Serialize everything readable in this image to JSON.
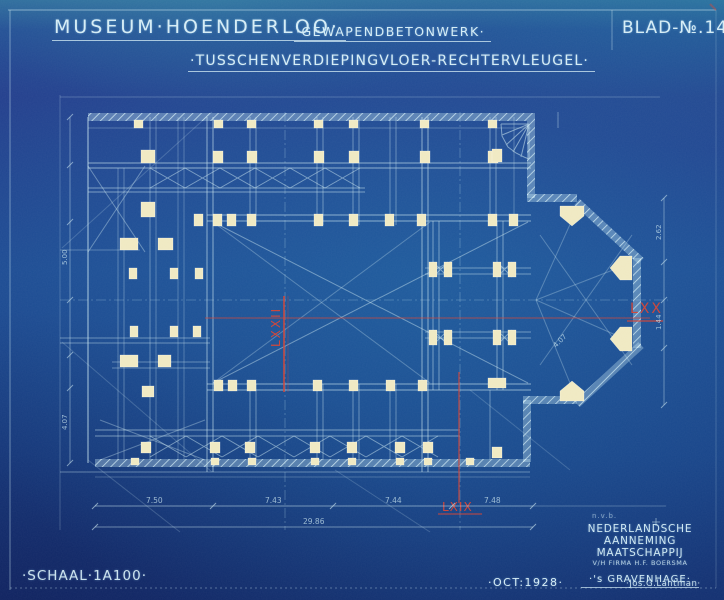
{
  "header": {
    "title": "MUSEUM·HOENDERLOO·",
    "work_type": "·GEWAPENDBETONWERK·",
    "sheet_no": "BLAD-№.14.",
    "drawing_title": "·TUSSCHENVERDIEPINGVLOER-RECHTERVLEUGEL·"
  },
  "footer": {
    "scale": "·SCHAAL·1A100·",
    "date": "·OCT:1928·",
    "signature": "·Jos.G.Lantman·",
    "stamp": "n.v.b.",
    "company": {
      "line1": "NEDERLANDSCHE",
      "line2": "AANNEMING MAATSCHAPPIJ",
      "line3": "V/H FIRMA H.F. BOERSMA",
      "line4": "·'s GRAVENHAGE·"
    }
  },
  "plan": {
    "section_marks": {
      "center_vertical": "LXXII",
      "lower_vertical": "LXIX",
      "horizontal": "LXX"
    },
    "dimensions": {
      "bay1": "7.50",
      "bay2": "7.43",
      "bay3": "7.44",
      "bay4": "7.48",
      "total": "29.86",
      "left_a": "5.00",
      "left_b": "4.07",
      "right_a": "2.62",
      "right_b": "1.44",
      "apse_a": "4.07"
    }
  },
  "colors": {
    "paper": "#1d4a92",
    "line": "#cfeaf2",
    "column": "#f0e9c2",
    "section_red": "#cd4438"
  }
}
